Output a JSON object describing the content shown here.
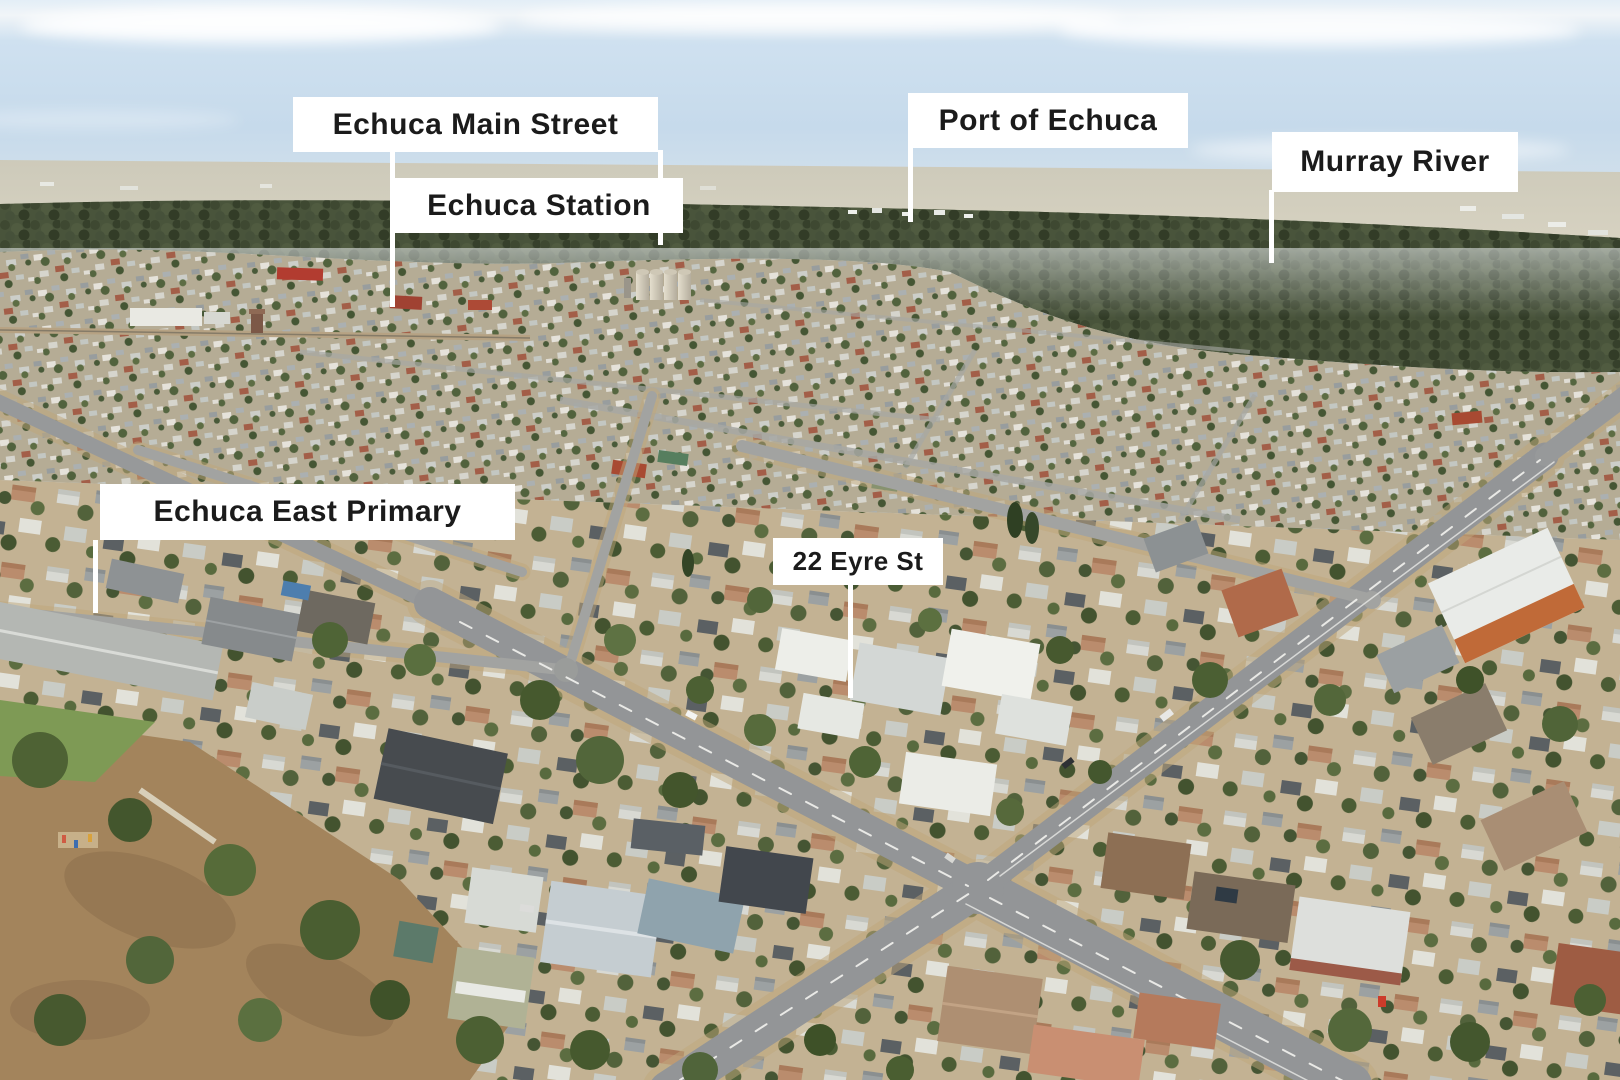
{
  "scene": {
    "description": "Aerial drone photograph of Echuca township with white location callout labels and pointer lines",
    "sky_color": "#cfe0ee",
    "forest_color": "#49543b",
    "road_color": "#97999a",
    "label_background": "#ffffff",
    "label_text_color": "#1b1b1b",
    "pointer_line_color": "#ffffff"
  },
  "annotations": [
    {
      "id": "echuca-main-street",
      "text": "Echuca Main Street"
    },
    {
      "id": "echuca-station",
      "text": "Echuca Station"
    },
    {
      "id": "port-of-echuca",
      "text": "Port of Echuca"
    },
    {
      "id": "murray-river",
      "text": "Murray River"
    },
    {
      "id": "echuca-east-primary",
      "text": "Echuca East Primary"
    },
    {
      "id": "property-22-eyre-st",
      "text": "22 Eyre St"
    }
  ]
}
